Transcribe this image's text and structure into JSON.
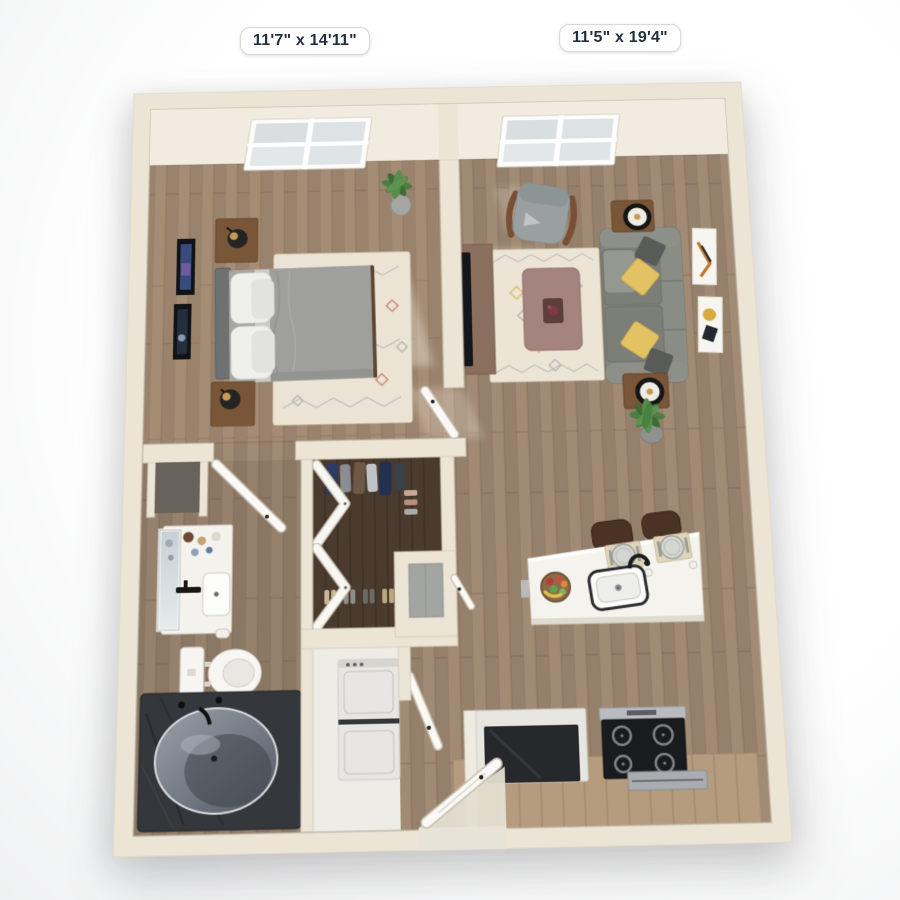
{
  "scene": {
    "type": "3d-floor-plan-top-view",
    "description": "One-bedroom apartment 3D rendered floor plan, top-down view",
    "unit_style": "feet-inches"
  },
  "labels": {
    "bedroom_dimensions": "11'7\" x 14'11\"",
    "living_room_dimensions": "11'5\" x 19'4\""
  },
  "palette": {
    "background": "#ffffff",
    "wall": "#ece5d6",
    "wall_edge": "#d9d0bd",
    "wall_face": "#f2ede2",
    "floor_wood": "#9c8772",
    "floor_closet": "#4b3b2e",
    "rug_cream": "#ebe3d3",
    "sofa_gray": "#82847e",
    "pillow_yellow": "#e2c262",
    "bed_duvet": "#9fa09d",
    "wood_furniture": "#7a5638",
    "coffee_table": "#a58480",
    "island_white": "#f5f3ed",
    "tub_dark": "#34373c",
    "appliance_black": "#191b1e",
    "plant_green": "#4c7f42",
    "label_text": "#232f3f"
  },
  "rooms": [
    {
      "name": "bedroom",
      "furniture": [
        "window",
        "queen-bed",
        "nightstand-2x",
        "table-lamp-2x",
        "wall-art-2x",
        "area-rug",
        "potted-plant",
        "door"
      ]
    },
    {
      "name": "living-room",
      "furniture": [
        "window",
        "sofa",
        "accent-chair",
        "coffee-table",
        "end-table-2x",
        "table-lamp-2x",
        "tv-console",
        "tv",
        "area-rug",
        "wall-art-2x",
        "potted-plant"
      ]
    },
    {
      "name": "bathroom",
      "furniture": [
        "vanity-sink",
        "mirror",
        "toilet",
        "soaking-tub",
        "linen-niche",
        "door"
      ]
    },
    {
      "name": "walk-in-closet",
      "furniture": [
        "hanging-clothes",
        "shoes",
        "bifold-doors",
        "utility-niche"
      ]
    },
    {
      "name": "laundry-closet",
      "furniture": [
        "stacked-washer-dryer",
        "door"
      ]
    },
    {
      "name": "kitchen",
      "furniture": [
        "island-with-sink",
        "faucet",
        "fruit-bowl",
        "place-setting-2x",
        "bar-stool-2x",
        "refrigerator",
        "range-cooktop",
        "counter"
      ]
    },
    {
      "name": "entry",
      "furniture": [
        "front-door"
      ]
    }
  ]
}
